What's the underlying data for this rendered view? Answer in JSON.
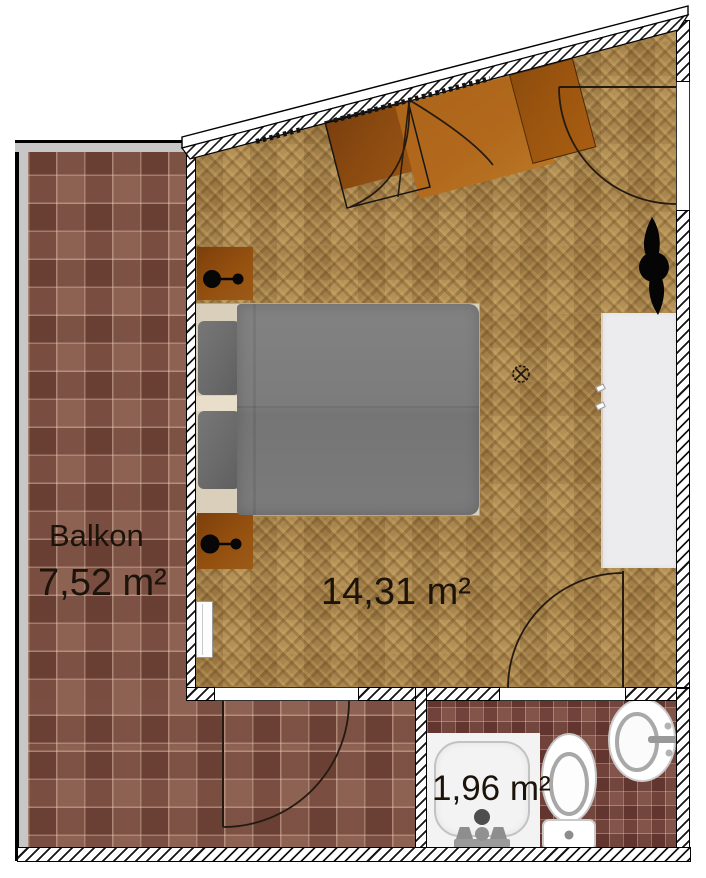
{
  "plan": {
    "title": "Apartment floor plan",
    "balcony": {
      "name": "Balkon",
      "area": "7,52 m²"
    },
    "bedroom": {
      "area": "14,31 m²"
    },
    "bathroom": {
      "area": "1,96 m²"
    }
  },
  "colors": {
    "parquet": "#a9844c",
    "balcony_tile": "#7d4f41",
    "bathroom_tile": "#73423a",
    "furniture_orange": "#b2691c",
    "furniture_dark_orange": "#8a4a10",
    "bed_duvet_gray": "#7e7e7e",
    "bed_frame_beige": "#dacfbb",
    "wardrobe_white": "#ececee",
    "label_text": "#1c130a",
    "rail_gray": "#c7c7c7"
  },
  "objects": [
    "double-bed",
    "pillows",
    "nightstand",
    "table-lamp",
    "wardrobe",
    "plant",
    "ceiling-light",
    "radiator",
    "door-swing",
    "window",
    "shower",
    "toilet",
    "sink",
    "balcony-railing"
  ]
}
